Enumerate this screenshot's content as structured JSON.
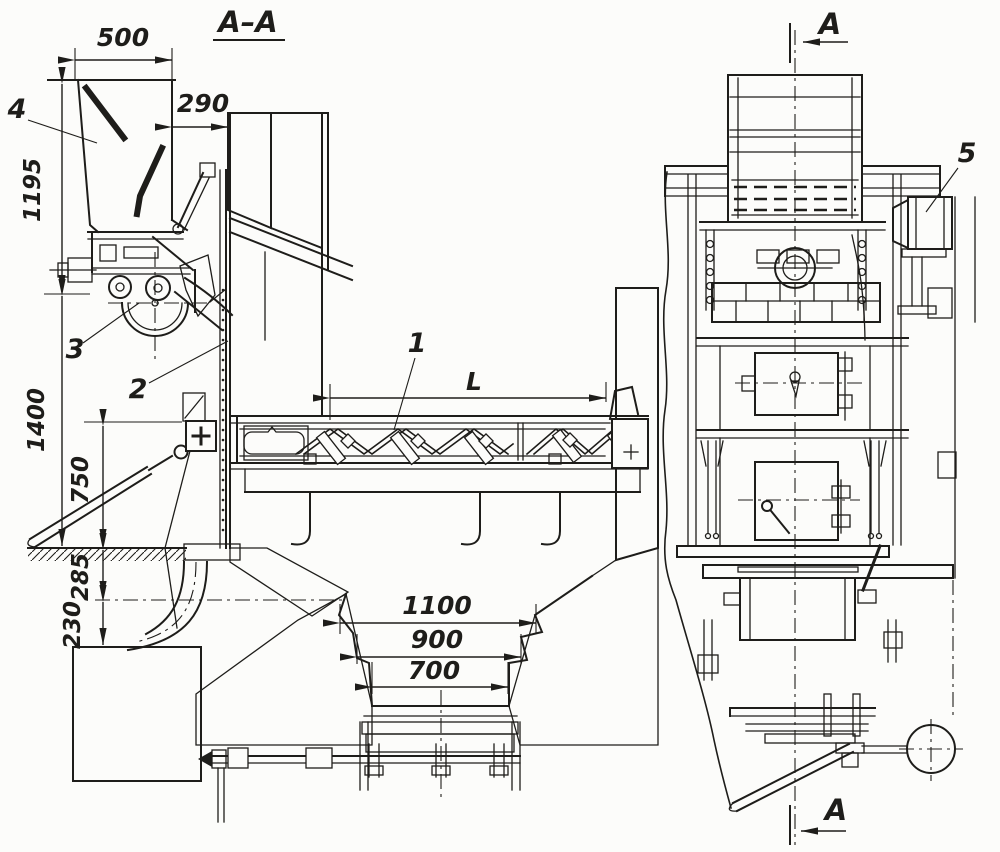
{
  "meta": {
    "drawing_type": "sectional technical drawing, two views",
    "paper_color": "#fcfcfa",
    "ink_color": "#1e1d1a"
  },
  "section": {
    "title": "A–A",
    "cut_marker_top": "A",
    "cut_marker_bottom": "A"
  },
  "part_labels": {
    "p1": "1",
    "p2": "2",
    "p3": "3",
    "p4": "4",
    "p5": "5"
  },
  "dims": {
    "hopper_width": "500",
    "hopper_to_wall": "290",
    "hopper_height": "1195",
    "front_height": "1400",
    "lever_height": "750",
    "floor_to_axis": "285",
    "axis_to_bin": "230",
    "conveyor_length": "L",
    "pit_width_top": "1100",
    "pit_width_middle": "900",
    "pit_width_bottom": "700"
  }
}
